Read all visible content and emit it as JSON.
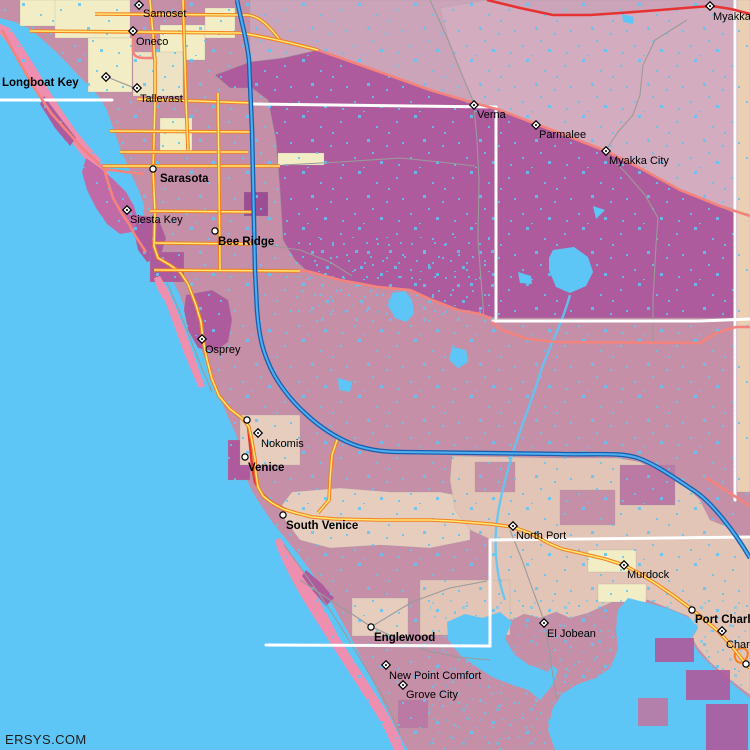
{
  "meta": {
    "watermark": "ERSYS.COM"
  },
  "colors": {
    "water": "#5EC6F6",
    "landBase": "#C48FA7",
    "purple": "#AE5B9D",
    "darkPurple": "#9C4E94",
    "mauveDeep": "#BA7AA4",
    "paleMauve": "#CBA4BA",
    "pinkMauve": "#D4ACBF",
    "tanStrip": "#EACFB3",
    "cream": "#F2EDC4",
    "tanLight": "#EDE2C4",
    "tanMid": "#E6CDBE",
    "tanBand": "#E2C5B6",
    "islandPink": "#EE8FB0",
    "islandPurple": "#C06BA8",
    "roadOrange": "#F28020",
    "roadYellow": "#FFE873",
    "roadRed": "#E63232",
    "roadSalmon": "#F4837D",
    "interstateCasing": "#1A5FAE",
    "interstateFill": "#4FAFF0",
    "minorRoad": "#9A9A9A",
    "countyLine": "#FFFFFF",
    "label": "#000000"
  },
  "land": {
    "mainland": "0,0 750,0 750,750 408,750 404,744 397,730 389,714 381,698 373,682 365,666 357,650 349,634 340,618 331,602 321,586 310,570 298,554 286,539 273,523 262,507 252,491 245,475 243,458 240,445 234,430 227,415 221,400 215,384 209,369 203,354 197,339 191,324 185,309 179,293 172,280 165,268 157,257 150,245 146,232 143,219 144,205 139,191 133,178 127,164 121,150 116,136 111,122 106,108 99,97 89,86 78,75 67,63 55,51 43,40 30,29 15,22 0,18"
  },
  "regions": [
    {
      "name": "bradenton-cream-1",
      "fill": "cream",
      "pts": "20,0 58,0 58,26 20,26"
    },
    {
      "name": "bradenton-cream-2",
      "fill": "cream",
      "pts": "55,0 130,0 130,38 55,38"
    },
    {
      "name": "bradenton-cream-3",
      "fill": "cream",
      "pts": "88,38 132,38 132,92 88,92"
    },
    {
      "name": "bradenton-cream-4",
      "fill": "cream",
      "pts": "160,25 205,25 205,60 160,60"
    },
    {
      "name": "bradenton-cream-5",
      "fill": "cream",
      "pts": "205,8 235,8 235,38 205,38"
    },
    {
      "name": "bradenton-tan",
      "fill": "tanLight",
      "pts": "133,52 183,52 183,96 133,96"
    },
    {
      "name": "airport-cream",
      "fill": "cream",
      "pts": "160,118 192,118 192,152 160,152"
    },
    {
      "name": "upper-right-pale",
      "fill": "paleMauve",
      "pts": "250,0 739,0 739,214 720,206 680,190 640,168 606,151 570,137 536,124 500,110 474,103 430,90 380,72 318,50 283,58 250,62"
    },
    {
      "name": "ne-pink-band",
      "fill": "pinkMauve",
      "pts": "460,70 448,38 440,8 487,0 520,8 553,15 620,13 697,7 739,9 739,210 720,205 680,189 640,167 606,150 570,136 536,123 500,109 474,102"
    },
    {
      "name": "right-edge-tan",
      "fill": "tanStrip",
      "pts": "737,0 750,0 750,492 737,492"
    },
    {
      "name": "myakka-purple",
      "fill": "purple",
      "outline": true,
      "pts": "215,75 250,62 283,58 318,50 380,72 430,90 474,103 500,110 536,124 570,137 606,151 640,168 680,190 720,206 736,214 736,318 496,318 480,314 458,310 432,300 410,290 378,287 340,280 307,271 295,260 283,240 280,190 276,140 268,100 252,88 230,88"
    },
    {
      "name": "fruitville-cream-strip",
      "fill": "cream",
      "pts": "278,153 324,153 324,165 278,165"
    },
    {
      "name": "sarasota-east-dark",
      "fill": "darkPurple",
      "pts": "244,192 268,192 268,216 244,216"
    },
    {
      "name": "sarasota-bay-purple",
      "fill": "purple",
      "pts": "136,215 158,218 166,238 160,258 147,262 138,250 134,232"
    },
    {
      "name": "gulfgate-purple",
      "fill": "purple",
      "pts": "150,252 184,252 184,282 150,282"
    },
    {
      "name": "osprey-purple",
      "fill": "purple",
      "pts": "186,295 212,290 228,300 232,320 228,342 214,352 198,348 188,330 184,310"
    },
    {
      "name": "venice-purple",
      "fill": "purple",
      "pts": "228,440 250,440 250,480 228,480"
    },
    {
      "name": "nokomis-tan",
      "fill": "tanMid",
      "pts": "240,415 300,415 300,465 240,465"
    },
    {
      "name": "south-venice-tan",
      "fill": "tanMid",
      "pts": "292,492 340,488 390,492 440,492 470,498 470,540 430,548 380,545 330,548 300,540 285,520 282,505"
    },
    {
      "name": "northport-band",
      "fill": "tanBand",
      "pts": "452,456 560,458 617,458 640,462 665,475 690,490 700,500 710,520 735,530 735,538 490,539 470,530 455,510 450,480"
    },
    {
      "name": "northport-mauve-1",
      "fill": "landBase",
      "pts": "475,462 515,462 515,492 475,492"
    },
    {
      "name": "northport-mauve-2",
      "fill": "landBase",
      "pts": "560,490 615,490 615,525 560,525"
    },
    {
      "name": "northport-mauve-3",
      "fill": "mauveDeep",
      "pts": "620,465 675,465 675,505 620,505"
    },
    {
      "name": "charlotte-band",
      "fill": "tanBand",
      "pts": "490,540 750,537 750,695 728,678 710,662 698,648 692,638 698,628 688,616 668,608 648,600 628,598 610,603 588,613 570,618 556,612 540,618 524,614 512,620 500,612 490,612"
    },
    {
      "name": "murdock-cream-1",
      "fill": "cream",
      "pts": "588,550 636,550 636,572 588,572"
    },
    {
      "name": "murdock-cream-2",
      "fill": "cream",
      "pts": "598,584 646,584 646,602 598,602"
    },
    {
      "name": "englewood-tan-1",
      "fill": "tanMid",
      "pts": "352,598 408,598 408,636 352,636"
    },
    {
      "name": "englewood-tan-2",
      "fill": "tanBand",
      "pts": "420,580 510,580 510,635 420,635"
    },
    {
      "name": "grove-purple",
      "fill": "mauveDeep",
      "pts": "398,700 428,700 428,728 398,728"
    }
  ],
  "islands": [
    {
      "name": "longboat-key",
      "fill": "islandPink",
      "pts": "0,24 10,28 22,46 36,68 50,92 63,112 76,131 90,148 101,160 108,172 112,184 106,186 96,172 84,158 70,140 56,120 40,96 26,72 12,48 0,34"
    },
    {
      "name": "longboat-purple-patch",
      "fill": "purple",
      "pts": "44,96 62,120 76,138 70,146 55,128 40,104"
    },
    {
      "name": "siesta-key-island",
      "fill": "islandPurple",
      "pts": "86,158 100,168 114,180 126,192 134,206 138,220 132,232 120,234 107,224 96,208 87,190 82,172"
    },
    {
      "name": "casey-key",
      "fill": "islandPink",
      "pts": "160,276 168,290 176,308 184,328 192,350 199,370 205,386 199,388 191,370 183,350 175,328 167,306 157,288 154,278"
    },
    {
      "name": "manasota-key",
      "fill": "islandPink",
      "pts": "280,538 290,552 300,566 310,584 320,602 330,620 338,636 347,650 356,664 365,678 374,692 383,706 392,722 400,738 404,750 394,750 385,730 376,714 367,700 358,686 349,672 340,658 331,644 322,630 312,614 302,598 292,580 284,564 277,548 275,540"
    },
    {
      "name": "manasota-purple-patch",
      "fill": "purple",
      "pts": "306,570 322,584 334,598 326,606 312,590 302,576"
    }
  ],
  "water_bodies": [
    {
      "name": "upper-myakka-lake",
      "pts": "553,250 574,247 588,257 593,272 586,286 570,293 556,287 549,270 549,258"
    },
    {
      "name": "pond-a",
      "pts": "518,272 531,276 532,284 520,283"
    },
    {
      "name": "lake-b",
      "pts": "392,293 405,291 412,300 414,314 406,322 395,318 388,306"
    },
    {
      "name": "lake-c",
      "pts": "452,347 466,350 468,362 458,368 449,360"
    },
    {
      "name": "pond-d",
      "pts": "338,378 352,382 350,392 339,390"
    },
    {
      "name": "pond-ne",
      "pts": "622,14 634,17 633,24 623,22"
    },
    {
      "name": "pond-tri",
      "pts": "593,206 605,210 596,219"
    },
    {
      "name": "myakka-river-mouth",
      "pts": "447,622 465,614 482,618 500,612 512,622 505,638 514,654 530,666 546,660 558,670 552,686 540,700 528,690 510,684 494,678 478,668 460,655 448,640"
    },
    {
      "name": "charlotte-harbor",
      "pts": "628,598 652,604 672,610 690,618 698,628 690,640 700,654 714,668 730,682 745,694 750,698 750,750 555,750 548,730 552,710 562,694 578,684 596,678 610,668 618,650 616,630 618,610"
    }
  ],
  "rivers": [
    {
      "name": "myakka-river",
      "path": "M570,295 C560,330 545,355 538,380 C530,405 520,430 512,455 C505,480 498,505 496,530 C494,555 498,580 505,600"
    }
  ],
  "overlays": [
    {
      "name": "pc-canal-1",
      "fill": "purple",
      "pts": "655,638 694,638 694,662 655,662"
    },
    {
      "name": "pc-canal-2",
      "fill": "purple",
      "pts": "686,670 730,670 730,700 686,700"
    },
    {
      "name": "pc-canal-3",
      "fill": "purple",
      "pts": "706,704 748,704 748,750 706,750"
    },
    {
      "name": "pc-canal-4",
      "fill": "mauveDeep",
      "pts": "638,698 668,698 668,726 638,726"
    },
    {
      "name": "harbor-islet",
      "fill": "landBase",
      "pts": "518,638 542,646 556,660 548,672 528,664 514,650"
    }
  ],
  "boundaries": {
    "minor": [
      {
        "name": "boundary-verna-n",
        "path": "M430,0 L448,40 L460,70 L474,103"
      },
      {
        "name": "boundary-verna-s",
        "path": "M474,107 L477,140 L479,180 L478,240 L481,280 L484,318"
      },
      {
        "name": "fruitville-ext",
        "path": "M283,165 L340,162 L400,158 L440,162 L475,166"
      },
      {
        "name": "myakka-city-n",
        "path": "M687,20 L655,40 L643,65 L640,95 L633,115 L618,132 L606,150"
      },
      {
        "name": "myakka-city-s",
        "path": "M606,153 L625,172 L645,195 L658,218 L656,245 L653,300 L653,342"
      },
      {
        "name": "tallevast-spur",
        "path": "M107,77 L137,89"
      },
      {
        "name": "bee-ridge-ext",
        "path": "M258,244 L300,250 L330,262 L352,276"
      },
      {
        "name": "coastal-road-n",
        "path": "M167,283 L178,308 L190,338 L201,366 L212,392"
      },
      {
        "name": "el-jobean-road",
        "path": "M510,530 L522,560 L532,588 L541,612 L544,622 L549,648 L553,676 L557,700"
      },
      {
        "name": "englewood-road-w",
        "path": "M300,580 L330,600 L352,614 L370,626 L398,639 L428,651 L458,657 L490,660"
      },
      {
        "name": "englewood-road-ne",
        "path": "M371,627 L412,602 L450,588 L487,581"
      },
      {
        "name": "manasota-beach-road",
        "path": "M284,545 L300,567 L315,588 L330,610 L344,632 L356,652 L368,672 L380,692 L391,712 L400,734"
      }
    ],
    "county": [
      {
        "name": "county-line-w",
        "path": "M0,100 L112,100"
      },
      {
        "name": "county-line-n",
        "path": "M253,104 L496,107"
      },
      {
        "name": "county-line-verna-v",
        "path": "M496,107 L496,318"
      },
      {
        "name": "county-line-e",
        "path": "M493,321 L700,321 L750,319"
      },
      {
        "name": "county-line-right-v",
        "path": "M735,0 L735,500"
      },
      {
        "name": "county-line-s",
        "path": "M490,540 L750,537"
      },
      {
        "name": "county-line-s-v",
        "path": "M490,540 L490,646"
      },
      {
        "name": "county-line-sw",
        "path": "M266,645 L490,646"
      }
    ]
  },
  "roads": [
    {
      "name": "sr70-red",
      "type": "red",
      "path": "M487,0 L520,8 L553,15 L590,15 L620,13 L660,10 L697,7 L712,6 L731,9 L750,14"
    },
    {
      "name": "venice-business-red",
      "type": "red",
      "path": "M248,426 L250,445 L252,465 L255,482 L262,494 L273,503 L287,510 L298,514"
    },
    {
      "name": "us301-diagonal",
      "type": "salmon",
      "path": "M318,50 L380,72 L430,90 L474,103 L500,110 L536,124 L570,137 L606,151 L640,168 L680,190 L720,206 L750,216"
    },
    {
      "name": "gulf-of-mexico-drive",
      "type": "salmon",
      "path": "M2,30 L16,56 L33,86 L51,113 L67,131 L83,149 L96,161 L104,169 L108,182 L113,198 L121,212 L129,224 L136,237 L146,252"
    },
    {
      "name": "ringling-bridge",
      "type": "salmon",
      "path": "M104,169 L126,172 L144,174"
    },
    {
      "name": "oneco-loop",
      "type": "salmon",
      "path": "M133,33 L133,50 C133,57 139,58 145,58 L153,58 L153,33"
    },
    {
      "name": "sr776-stub",
      "type": "salmon",
      "path": "M705,477 L750,506"
    },
    {
      "name": "clark-road-ext",
      "type": "salmon",
      "path": "M300,271 L307,271 L340,280 L378,287 L410,290 L432,300 L458,310 L480,314 L492,319"
    },
    {
      "name": "sr72-east",
      "type": "salmon",
      "path": "M492,322 L502,330 L527,339 L557,342 L700,343 L716,333 L736,327 L750,327"
    },
    {
      "name": "tamiami-trail",
      "type": "highway",
      "path": "M150,0 L153,34 L155,62 L155,99 L154,140 L153,169 L155,212 L154,246 L158,258 L170,265 L180,272 L188,284 L196,305 L201,322 L203,340 L207,360 L212,379 L219,396 L230,409 L243,419 L249,427 L252,441 L255,459 L256,474 L258,487 L263,496 L272,503 L283,509 L296,513 L312,517 L335,519 L380,520 L430,520 L452,521 L490,524 L513,527 L532,534 L548,543 L562,549 L580,553 L605,559 L624,565 L642,575 L658,585 L674,596 L690,608 L705,620 L718,631 L729,643 L738,654 L745,663 L750,668"
    },
    {
      "name": "university-pkwy",
      "type": "highway",
      "path": "M137,99 L253,103"
    },
    {
      "name": "us41-north",
      "type": "highway",
      "path": "M95,14 L248,15 C262,17 272,30 280,40"
    },
    {
      "name": "oneco-road",
      "type": "highway",
      "path": "M30,31 L240,33 C262,36 295,44 318,50"
    },
    {
      "name": "myrtle-st",
      "type": "highway",
      "path": "M110,131 L252,132"
    },
    {
      "name": "mlk-way",
      "type": "highway",
      "path": "M120,152 L248,152"
    },
    {
      "name": "fruitville-road",
      "type": "highway",
      "path": "M103,166 L280,166"
    },
    {
      "name": "bahia-vista",
      "type": "highway",
      "path": "M150,211 L256,212"
    },
    {
      "name": "bee-ridge-road",
      "type": "highway",
      "path": "M155,243 L258,244"
    },
    {
      "name": "clark-road",
      "type": "highway",
      "path": "M154,270 L300,271"
    },
    {
      "name": "us301-v",
      "type": "highway",
      "path": "M183,0 L186,100 L188,150"
    },
    {
      "name": "tuttle-ave",
      "type": "highway",
      "path": "M218,93 L220,270"
    },
    {
      "name": "venice-connector",
      "type": "highway",
      "path": "M338,437 L332,455 L330,480 L329,500 L318,513"
    },
    {
      "name": "pc-interchange-loop",
      "type": "ramp",
      "path": "M737,650 C746,644 752,654 744,661 C738,667 731,656 737,650"
    },
    {
      "name": "interstate-75",
      "type": "interstate",
      "path": "M237,0 C242,25 247,40 249,60 L252,130 L255,270 L257,310 C259,335 262,348 268,362 C275,380 290,400 307,415 C320,427 335,437 352,444 C365,449 380,452 400,452 L560,454 C595,455 620,452 638,458 C655,464 675,478 696,492 C712,503 735,532 750,558"
    }
  ],
  "cities": [
    {
      "name": "Samoset",
      "bold": false,
      "marker": "diamond",
      "mx": 139,
      "my": 5,
      "lx": 143,
      "ly": 17
    },
    {
      "name": "Oneco",
      "bold": false,
      "marker": "diamond",
      "mx": 133,
      "my": 31,
      "lx": 136,
      "ly": 45
    },
    {
      "name": "Longboat Key",
      "bold": true,
      "marker": null,
      "lx": 2,
      "ly": 86
    },
    {
      "name": "Tallevast",
      "bold": false,
      "marker": "diamond",
      "mx": 137,
      "my": 88,
      "lx": 140,
      "ly": 102
    },
    {
      "name": "Sarasota",
      "bold": true,
      "marker": "circle",
      "mx": 153,
      "my": 169,
      "lx": 160,
      "ly": 182
    },
    {
      "name": "Siesta Key",
      "bold": false,
      "marker": "diamond",
      "mx": 127,
      "my": 210,
      "lx": 130,
      "ly": 223
    },
    {
      "name": "Bee Ridge",
      "bold": true,
      "marker": "circle",
      "mx": 215,
      "my": 231,
      "lx": 218,
      "ly": 245
    },
    {
      "name": "Verna",
      "bold": false,
      "marker": "diamond",
      "mx": 474,
      "my": 105,
      "lx": 477,
      "ly": 118
    },
    {
      "name": "Myakka",
      "bold": false,
      "marker": "diamond",
      "mx": 710,
      "my": 6,
      "lx": 713,
      "ly": 20
    },
    {
      "name": "Parmalee",
      "bold": false,
      "marker": "diamond",
      "mx": 536,
      "my": 125,
      "lx": 539,
      "ly": 138
    },
    {
      "name": "Myakka City",
      "bold": false,
      "marker": "diamond",
      "mx": 606,
      "my": 151,
      "lx": 609,
      "ly": 164
    },
    {
      "name": "Osprey",
      "bold": false,
      "marker": "diamond",
      "mx": 202,
      "my": 339,
      "lx": 205,
      "ly": 353
    },
    {
      "name": "Nokomis",
      "bold": false,
      "marker": "diamond",
      "mx": 258,
      "my": 433,
      "lx": 261,
      "ly": 447
    },
    {
      "name": "",
      "bold": false,
      "marker": "circle",
      "mx": 247,
      "my": 420
    },
    {
      "name": "",
      "bold": false,
      "marker": "diamond",
      "mx": 106,
      "my": 77
    },
    {
      "name": "Venice",
      "bold": true,
      "marker": "circle",
      "mx": 245,
      "my": 457,
      "lx": 248,
      "ly": 471
    },
    {
      "name": "South Venice",
      "bold": true,
      "marker": "circle",
      "mx": 283,
      "my": 515,
      "lx": 286,
      "ly": 529
    },
    {
      "name": "North Port",
      "bold": false,
      "marker": "diamond",
      "mx": 513,
      "my": 526,
      "lx": 516,
      "ly": 539
    },
    {
      "name": "Murdock",
      "bold": false,
      "marker": "diamond",
      "mx": 624,
      "my": 565,
      "lx": 627,
      "ly": 578
    },
    {
      "name": "El Jobean",
      "bold": false,
      "marker": "diamond",
      "mx": 544,
      "my": 623,
      "lx": 547,
      "ly": 637
    },
    {
      "name": "Port Charlotte",
      "bold": true,
      "marker": "circle",
      "mx": 692,
      "my": 610,
      "lx": 695,
      "ly": 623
    },
    {
      "name": "Charlotte Harbor",
      "bold": false,
      "marker": "diamond",
      "mx": 722,
      "my": 631,
      "lx": 726,
      "ly": 648
    },
    {
      "name": "Englewood",
      "bold": true,
      "marker": "circle",
      "mx": 371,
      "my": 627,
      "lx": 374,
      "ly": 641
    },
    {
      "name": "New Point Comfort",
      "bold": false,
      "marker": "diamond",
      "mx": 386,
      "my": 665,
      "lx": 389,
      "ly": 679
    },
    {
      "name": "Grove City",
      "bold": false,
      "marker": "diamond",
      "mx": 403,
      "my": 685,
      "lx": 406,
      "ly": 698
    },
    {
      "name": "",
      "bold": false,
      "marker": "circle",
      "mx": 746,
      "my": 664
    }
  ]
}
